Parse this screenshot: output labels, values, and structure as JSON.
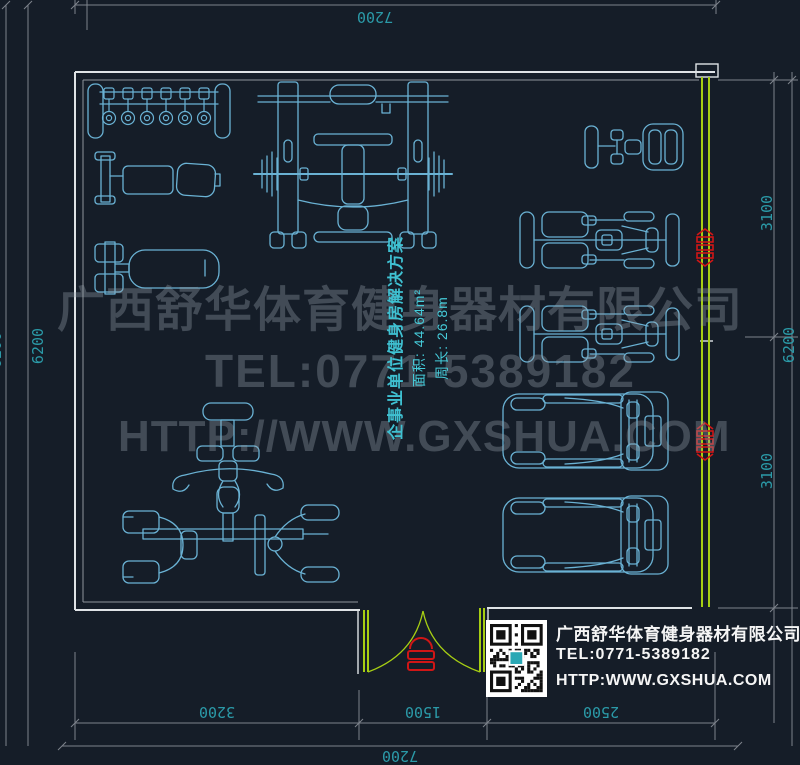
{
  "drawing": {
    "room_label_title": "企事业单位健身房解决方案",
    "room_label_area": "面积: 44.64m²",
    "room_label_perimeter": "周长: 26.8m",
    "dim_top_total": "7200",
    "dim_bottom_seg_left": "3200",
    "dim_bottom_seg_mid": "1500",
    "dim_bottom_seg_right": "2500",
    "dim_bottom_total": "7200",
    "dim_left_inner": "6200",
    "dim_left_outer": "6200",
    "dim_right_seg_top": "3100",
    "dim_right_seg_bottom": "3100",
    "dim_right_total": "6200",
    "equipment": [
      "dumbbell-rack",
      "adjustable-bench",
      "flat-bench",
      "smith-machine-with-barbell",
      "upright-exercise-bike",
      "recumbent-bike",
      "recumbent-bike",
      "treadmill",
      "treadmill",
      "multi-station-gym"
    ]
  },
  "watermark": {
    "company": "广西舒华体育健身器材有限公司",
    "tel": "TEL:0771-5389182",
    "url": "HTTP://WWW.GXSHUA.COM"
  },
  "info_block": {
    "company": "广西舒华体育健身器材有限公司",
    "tel": "TEL:0771-5389182",
    "url": "HTTP:WWW.GXSHUA.COM",
    "qr_icon": "qr-code"
  },
  "colors": {
    "background": "#151d28",
    "equipment_line": "#6ab2d4",
    "wall_line": "#dfe3e6",
    "door_wall_green": "#a6ce13",
    "dimension_line": "#7d838c",
    "dimension_text": "#2b9aa8",
    "label_text": "#3fc1d2",
    "marker_red": "#d01616",
    "watermark_text": "#8f99a4",
    "info_text": "#ffffff"
  }
}
